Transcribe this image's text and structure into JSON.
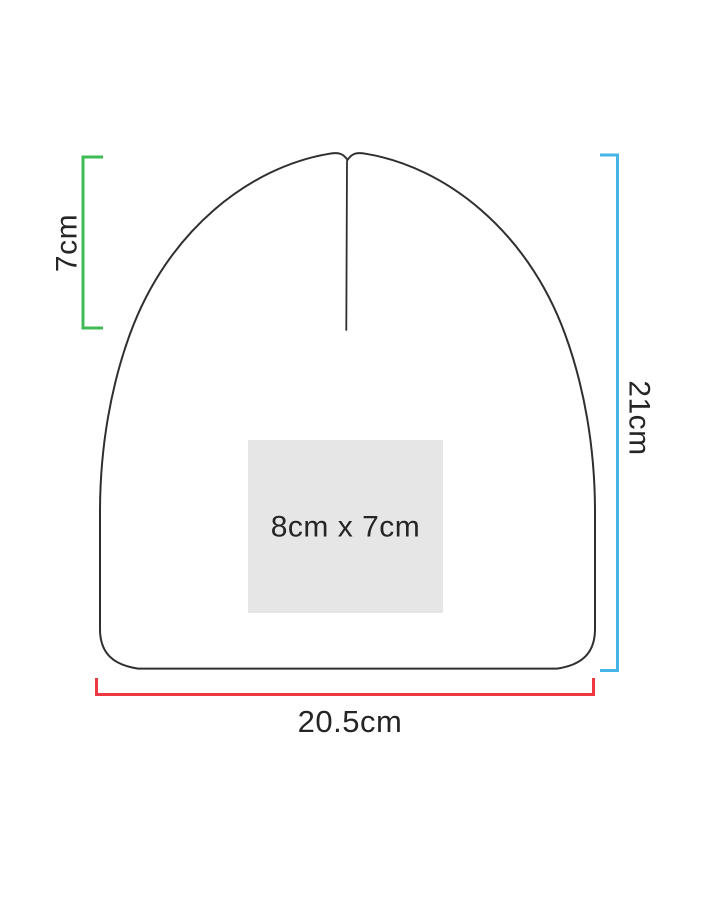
{
  "diagram": {
    "type": "beanie-print-area-spec",
    "labels": {
      "crown_height": "7cm",
      "total_height": "21cm",
      "width": "20.5cm",
      "print_area": "8cm x 7cm"
    },
    "colors": {
      "crown_bracket": "#3fbb54",
      "height_bracket": "#45b5e8",
      "width_bracket": "#ee3942",
      "outline": "#2f2f2f",
      "print_area_fill": "#e6e6e6",
      "label_text": "#262424",
      "background": "#ffffff"
    }
  }
}
